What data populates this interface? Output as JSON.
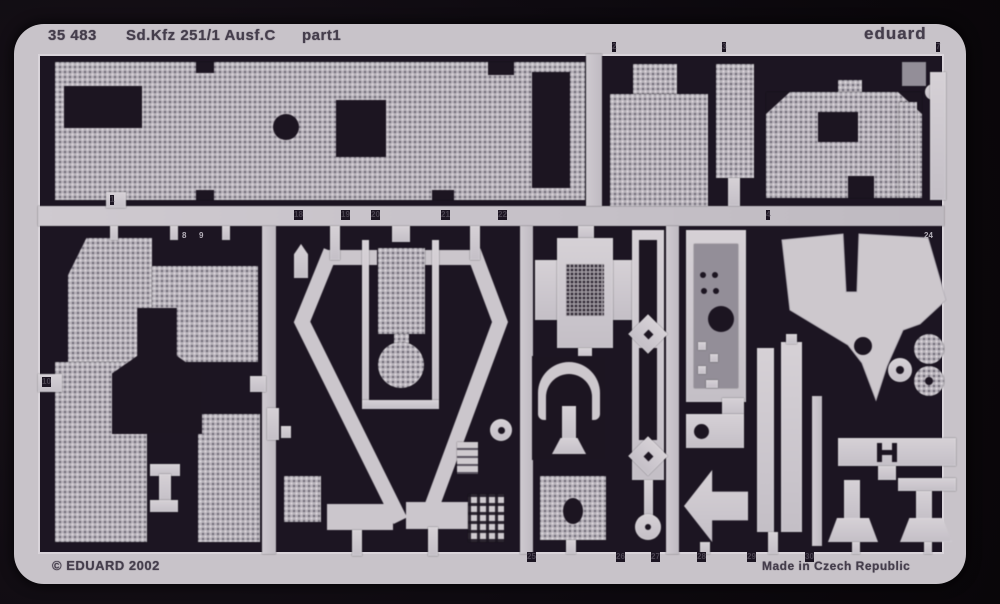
{
  "header": {
    "catalog_number": "35 483",
    "title": "Sd.Kfz 251/1 Ausf.C",
    "sheet_label": "part1",
    "brand": "eduard"
  },
  "footer": {
    "copyright": "© EDUARD 2002",
    "origin": "Made in Czech Republic"
  },
  "colors": {
    "photo_background": "#0e0a10",
    "fret_interior": "#1c1522",
    "metal_light": "#cdc8cd",
    "metal_texture_base": "#b7b2ba",
    "metal_texture_dot": "#6e6977",
    "stamp_text": "#453e4c"
  },
  "part_labels": [
    {
      "text": "1",
      "x": 110,
      "y": 195,
      "tone": "dark"
    },
    {
      "text": "2",
      "x": 612,
      "y": 42,
      "tone": "dark"
    },
    {
      "text": "3",
      "x": 722,
      "y": 42,
      "tone": "dark"
    },
    {
      "text": "4",
      "x": 766,
      "y": 210,
      "tone": "dark"
    },
    {
      "text": "7",
      "x": 936,
      "y": 42,
      "tone": "dark"
    },
    {
      "text": "8",
      "x": 182,
      "y": 231,
      "tone": "light"
    },
    {
      "text": "9",
      "x": 199,
      "y": 231,
      "tone": "light"
    },
    {
      "text": "10",
      "x": 42,
      "y": 377,
      "tone": "dark"
    },
    {
      "text": "18",
      "x": 294,
      "y": 210,
      "tone": "dark"
    },
    {
      "text": "19",
      "x": 341,
      "y": 210,
      "tone": "dark"
    },
    {
      "text": "20",
      "x": 371,
      "y": 210,
      "tone": "dark"
    },
    {
      "text": "21",
      "x": 441,
      "y": 210,
      "tone": "dark"
    },
    {
      "text": "22",
      "x": 498,
      "y": 210,
      "tone": "dark"
    },
    {
      "text": "24",
      "x": 924,
      "y": 231,
      "tone": "light"
    },
    {
      "text": "25",
      "x": 527,
      "y": 552,
      "tone": "dark"
    },
    {
      "text": "26",
      "x": 616,
      "y": 552,
      "tone": "dark"
    },
    {
      "text": "27",
      "x": 651,
      "y": 552,
      "tone": "dark"
    },
    {
      "text": "28",
      "x": 697,
      "y": 552,
      "tone": "dark"
    },
    {
      "text": "29",
      "x": 747,
      "y": 552,
      "tone": "dark"
    },
    {
      "text": "30",
      "x": 805,
      "y": 552,
      "tone": "dark"
    }
  ]
}
